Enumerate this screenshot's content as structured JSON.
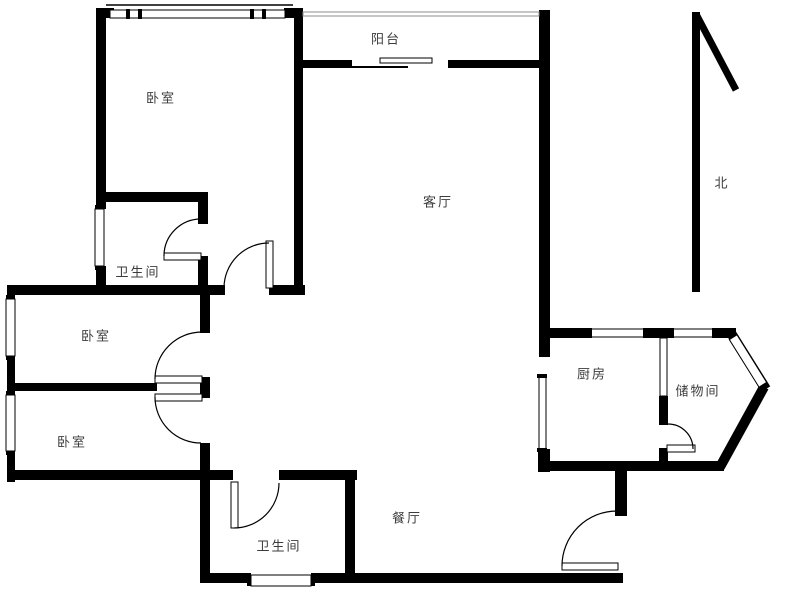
{
  "rooms": {
    "bedroom_top": {
      "label": "卧室"
    },
    "balcony": {
      "label": "阳台"
    },
    "living_room": {
      "label": "客厅"
    },
    "bathroom_upper": {
      "label": "卫生间"
    },
    "bedroom_middle": {
      "label": "卧室"
    },
    "bedroom_lower": {
      "label": "卧室"
    },
    "bathroom_lower": {
      "label": "卫生间"
    },
    "dining_room": {
      "label": "餐厅"
    },
    "kitchen": {
      "label": "厨房"
    },
    "storage_room": {
      "label": "储物间"
    }
  },
  "compass": {
    "north_label": "北"
  },
  "colors": {
    "wall": "#000000",
    "label": "#3c3c3c",
    "rail": "#8c8c8c",
    "bg": "#ffffff"
  }
}
